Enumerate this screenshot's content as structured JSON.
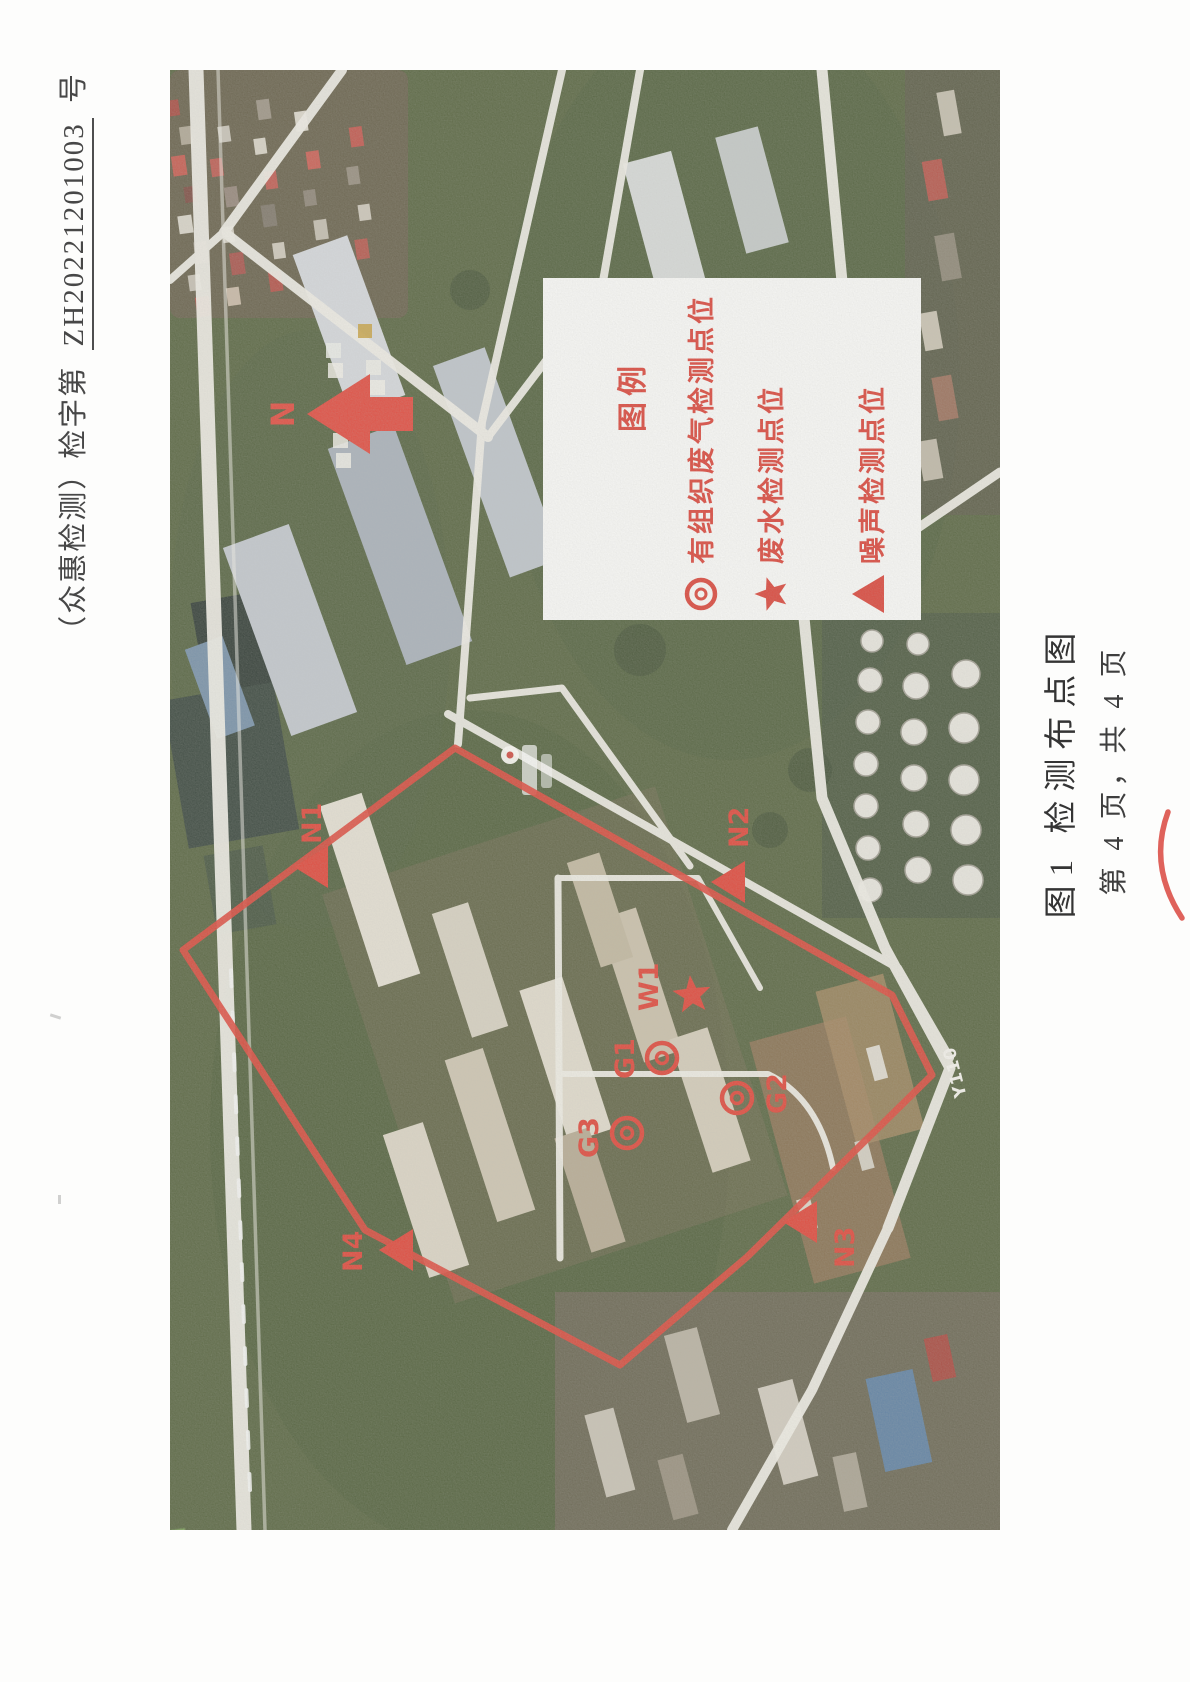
{
  "document": {
    "header": {
      "prefix": "（众惠检测）检字第",
      "number": "ZH20221201003",
      "suffix": "号"
    },
    "figure_caption": "图1 检测布点图",
    "page_footer": "第 4 页，共 4 页"
  },
  "legend": {
    "title": "图例",
    "items": [
      {
        "symbol": "double-circle-icon",
        "label": "有组织废气检测点位"
      },
      {
        "symbol": "star-icon",
        "label": "废水检测点位"
      },
      {
        "symbol": "triangle-icon",
        "label": "噪声检测点位"
      }
    ]
  },
  "map": {
    "compass_label": "N",
    "road_label": "Y110",
    "noise_points": [
      "N1",
      "N2",
      "N3",
      "N4"
    ],
    "gas_points": [
      "G1",
      "G2",
      "G3"
    ],
    "wastewater_points": [
      "W1"
    ]
  },
  "colors": {
    "marker_red": "#e14437",
    "boundary_red": "#e0463a",
    "legend_red": "#dc4237",
    "text_dark": "#3e3e3e",
    "road_white": "#f1efe7"
  }
}
